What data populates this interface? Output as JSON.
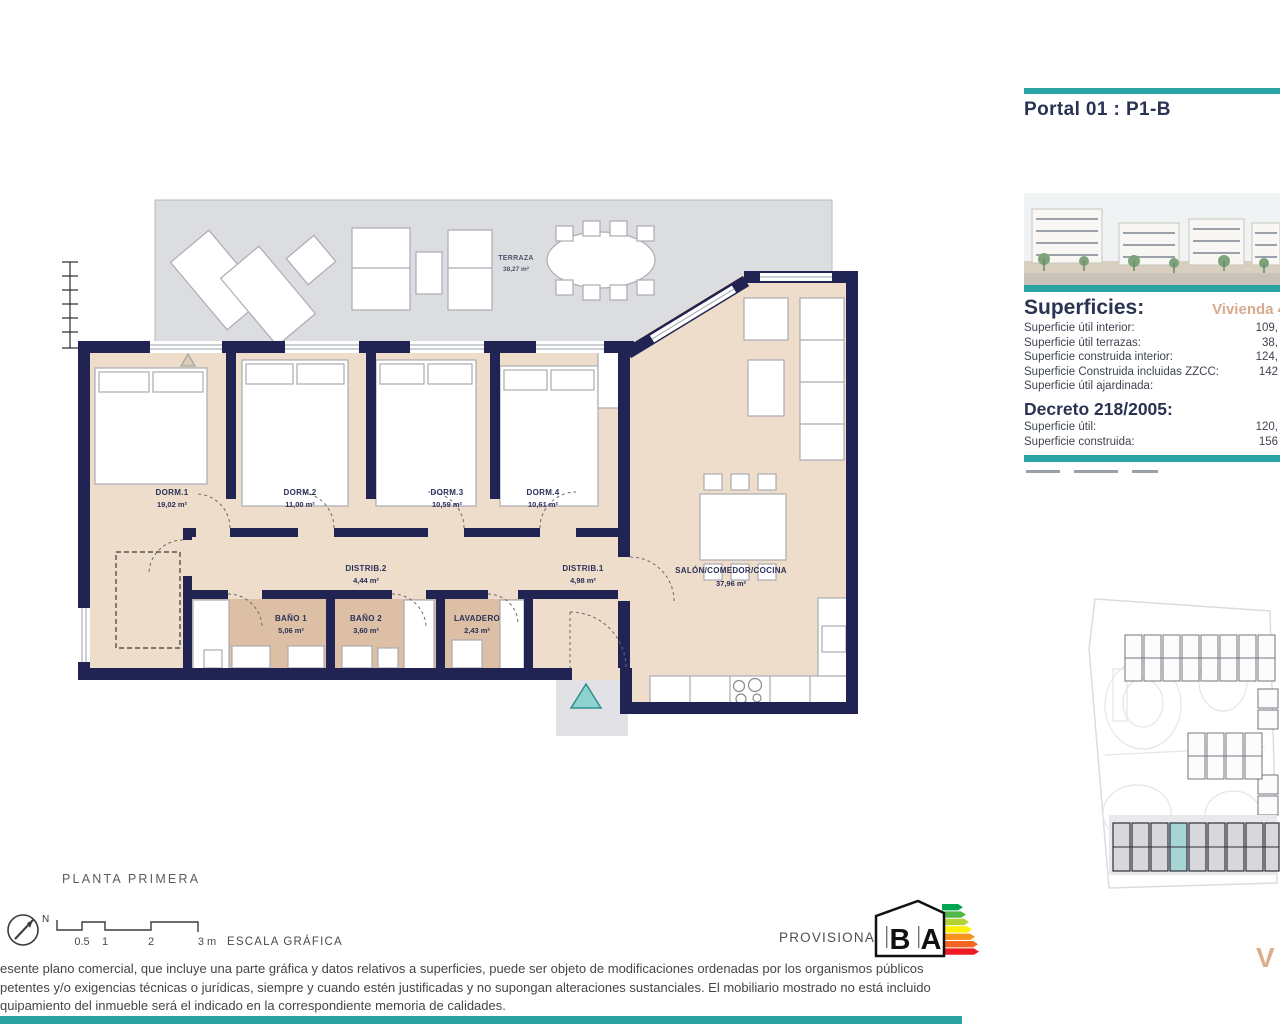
{
  "title": {
    "portal": "Portal 01 : P1-B"
  },
  "panel": {
    "superficies_heading": "Superficies:",
    "vivienda_label": "Vivienda 4",
    "superficies_rows": [
      {
        "label": "Superficie útil interior:",
        "value": "109,"
      },
      {
        "label": "Superficie útil terrazas:",
        "value": "38,"
      },
      {
        "label": "Superficie construida interior:",
        "value": "124,"
      },
      {
        "label": "Superficie Construida incluidas ZZCC:",
        "value": "142"
      },
      {
        "label": "Superficie útil ajardinada:",
        "value": ""
      }
    ],
    "decreto_heading": "Decreto 218/2005:",
    "decreto_rows": [
      {
        "label": "Superficie útil:",
        "value": "120,"
      },
      {
        "label": "Superficie construida:",
        "value": "156"
      }
    ]
  },
  "floor_plan": {
    "rooms": [
      {
        "name": "TERRAZA",
        "area": "38,27 m²"
      },
      {
        "name": "DORM.1",
        "area": "19,02 m²"
      },
      {
        "name": "DORM.2",
        "area": "11,00 m²"
      },
      {
        "name": "DORM.3",
        "area": "10,59 m²"
      },
      {
        "name": "DORM.4",
        "area": "10,61 m²"
      },
      {
        "name": "DISTRIB.2",
        "area": "4,44 m²"
      },
      {
        "name": "DISTRIB.1",
        "area": "4,98 m²"
      },
      {
        "name": "SALÓN/COMEDOR/COCINA",
        "area": "37,96 m²"
      },
      {
        "name": "BAÑO 1",
        "area": "5,06 m²"
      },
      {
        "name": "BAÑO 2",
        "area": "3,60 m²"
      },
      {
        "name": "LAVADERO",
        "area": "2,43 m²"
      }
    ]
  },
  "footer": {
    "floor_title": "PLANTA PRIMERA",
    "north_label": "N",
    "scale": {
      "ticks": [
        "0.5",
        "1",
        "2",
        "3 m"
      ],
      "caption": "ESCALA GRÁFICA"
    },
    "provisional_label": "PROVISIONAL",
    "energy": {
      "letter_b": "B",
      "letter_a": "A"
    },
    "brand_initial": "V",
    "legal_lines": [
      "esente plano comercial, que incluye una parte gráfica y datos relativos a superficies, puede ser objeto de modificaciones ordenadas por los organismos públicos",
      "petentes y/o exigencias técnicas o jurídicas, siempre y cuando estén justificadas y no supongan alteraciones sustanciales. El mobiliario mostrado no está incluido",
      "quipamiento del inmueble será el indicado en la correspondiente memoria de calidades."
    ]
  },
  "colors": {
    "teal": "#2BA3A3",
    "navy_wall": "#212453",
    "heading_navy": "#2B3352",
    "accent_tan": "#D9A98B",
    "room_beige": "#EDDDCA",
    "bath_tan": "#DCBFA5",
    "terrace_gray": "#DCDDE1"
  }
}
